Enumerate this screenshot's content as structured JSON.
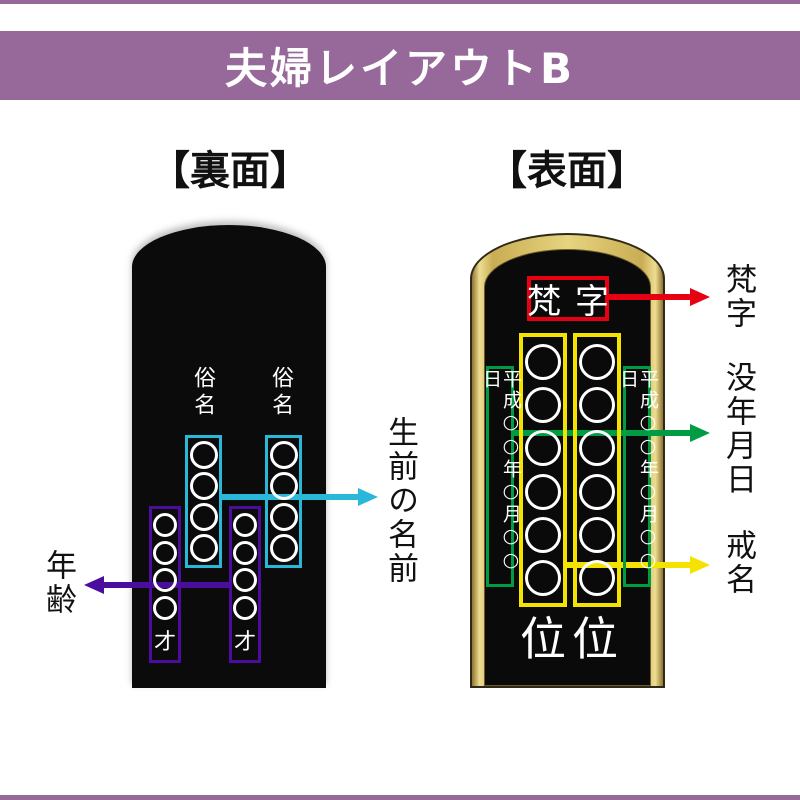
{
  "banner": {
    "title": "夫婦レイアウトB"
  },
  "back_panel": {
    "heading": "【裏面】",
    "name_label_left": "俗名",
    "name_label_right": "俗名",
    "age_char_left": "才",
    "age_char_right": "才"
  },
  "front_panel": {
    "heading": "【表面】",
    "bonji_text": "梵字",
    "date_text_left": "平成○○年○月○○日",
    "date_text_right": "平成○○年○月○○日",
    "rank_char_left": "位",
    "rank_char_right": "位"
  },
  "annotations": {
    "living_name": "生前の名前",
    "age": "年齢",
    "bonji": "梵字",
    "death_date": "没年月日",
    "buddhist_name": "戒名"
  },
  "colors": {
    "banner_purple": "#97699b",
    "arrow_cyan": "#29b8da",
    "arrow_purple": "#4b0d9e",
    "arrow_red": "#e60012",
    "arrow_green": "#009c43",
    "arrow_yellow": "#f4e300",
    "tablet_gold": "#d8c068",
    "tablet_black": "#0b0b0b"
  }
}
